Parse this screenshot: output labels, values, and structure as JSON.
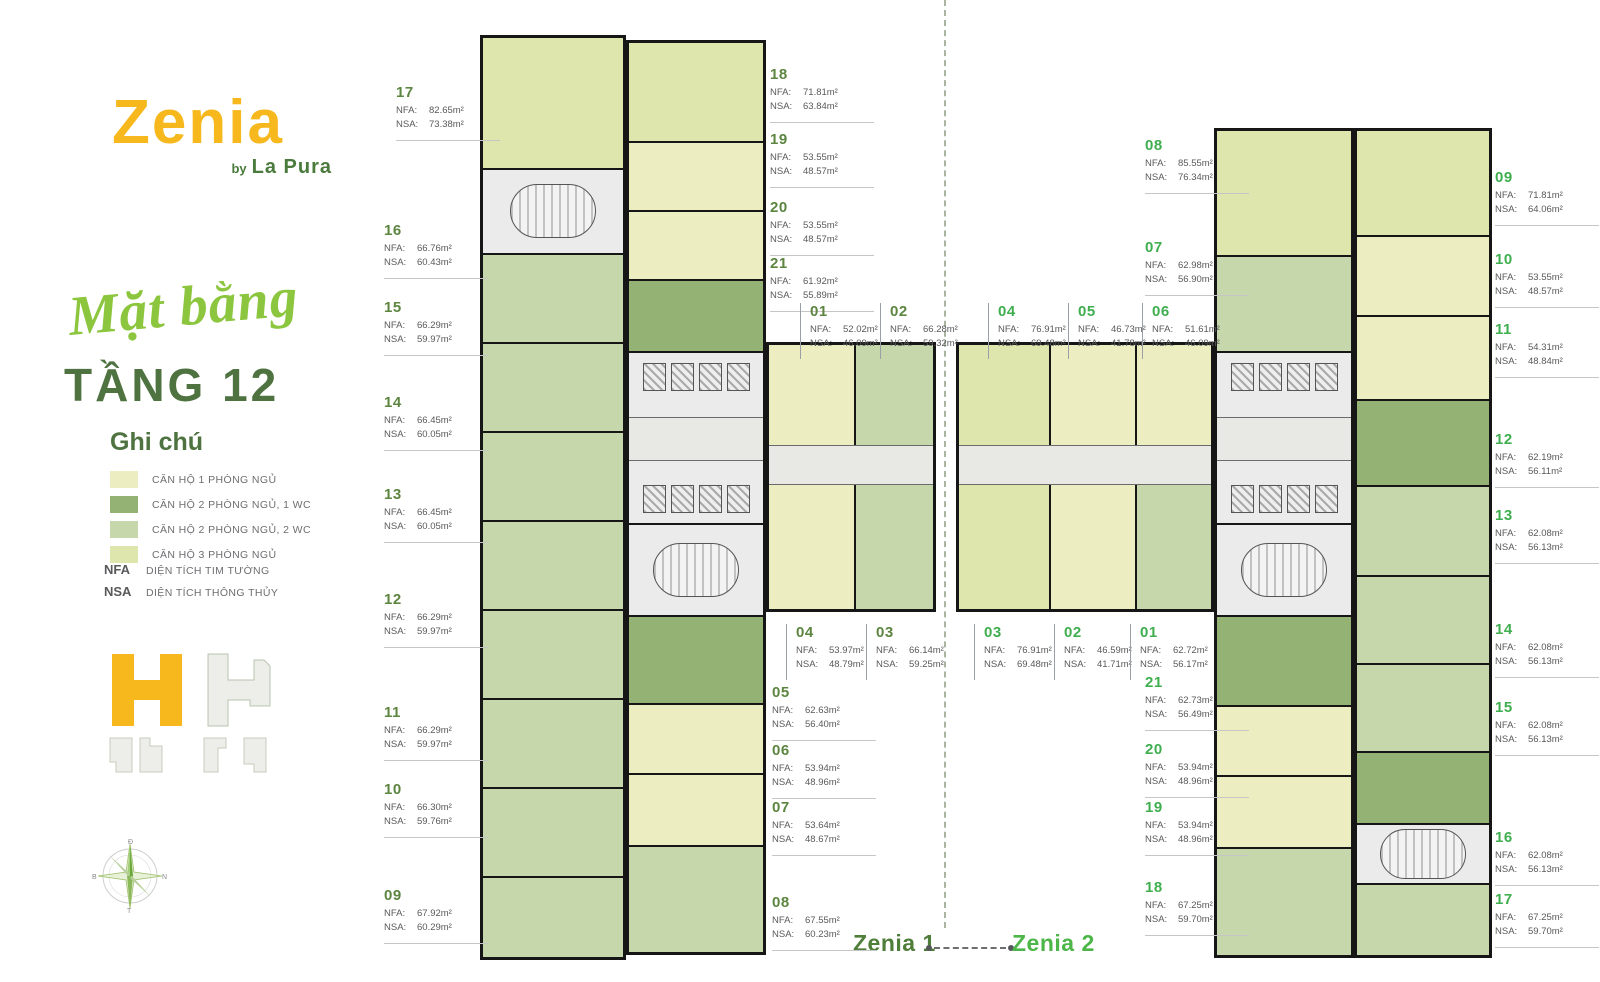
{
  "brand": {
    "name": "Zenia",
    "by": "by",
    "sub_brand": "La Pura"
  },
  "heading": {
    "script": "Mặt bằng",
    "floor": "TẦNG 12"
  },
  "legend": {
    "title": "Ghi chú",
    "types": [
      {
        "label": "CĂN HỘ 1 PHÒNG NGỦ",
        "color": "#ecedc0"
      },
      {
        "label": "CĂN HỘ 2 PHÒNG NGỦ, 1 WC",
        "color": "#94b274"
      },
      {
        "label": "CĂN HỘ 2 PHÒNG NGỦ, 2 WC",
        "color": "#c6d7ab"
      },
      {
        "label": "CĂN HỘ 3 PHÒNG NGỦ",
        "color": "#dee6ad"
      }
    ],
    "abbreviations": [
      {
        "key": "NFA",
        "label": "DIỆN TÍCH TIM TƯỜNG"
      },
      {
        "key": "NSA",
        "label": "DIỆN TÍCH THÔNG THỦY"
      }
    ]
  },
  "footer": {
    "left_tower": "Zenia 1",
    "right_tower": "Zenia 2"
  },
  "compass": {
    "top": "Đ",
    "right": "N",
    "bottom": "T",
    "left": "B"
  },
  "unit_labels": [
    {
      "tower": "z1",
      "no": "17",
      "nfa": "82.65m²",
      "nsa": "73.38m²",
      "x": 396,
      "y": 84
    },
    {
      "tower": "z1",
      "no": "16",
      "nfa": "66.76m²",
      "nsa": "60.43m²",
      "x": 384,
      "y": 222
    },
    {
      "tower": "z1",
      "no": "15",
      "nfa": "66.29m²",
      "nsa": "59.97m²",
      "x": 384,
      "y": 299
    },
    {
      "tower": "z1",
      "no": "14",
      "nfa": "66.45m²",
      "nsa": "60.05m²",
      "x": 384,
      "y": 394
    },
    {
      "tower": "z1",
      "no": "13",
      "nfa": "66.45m²",
      "nsa": "60.05m²",
      "x": 384,
      "y": 486
    },
    {
      "tower": "z1",
      "no": "12",
      "nfa": "66.29m²",
      "nsa": "59.97m²",
      "x": 384,
      "y": 591
    },
    {
      "tower": "z1",
      "no": "11",
      "nfa": "66.29m²",
      "nsa": "59.97m²",
      "x": 384,
      "y": 704
    },
    {
      "tower": "z1",
      "no": "10",
      "nfa": "66.30m²",
      "nsa": "59.76m²",
      "x": 384,
      "y": 781
    },
    {
      "tower": "z1",
      "no": "09",
      "nfa": "67.92m²",
      "nsa": "60.29m²",
      "x": 384,
      "y": 887
    },
    {
      "tower": "z1",
      "no": "18",
      "nfa": "71.81m²",
      "nsa": "63.84m²",
      "x": 770,
      "y": 66
    },
    {
      "tower": "z1",
      "no": "19",
      "nfa": "53.55m²",
      "nsa": "48.57m²",
      "x": 770,
      "y": 131
    },
    {
      "tower": "z1",
      "no": "20",
      "nfa": "53.55m²",
      "nsa": "48.57m²",
      "x": 770,
      "y": 199
    },
    {
      "tower": "z1",
      "no": "21",
      "nfa": "61.92m²",
      "nsa": "55.89m²",
      "x": 770,
      "y": 255
    },
    {
      "tower": "z1",
      "no": "01",
      "nfa": "52.02m²",
      "nsa": "46.09m²",
      "x": 800,
      "y": 303,
      "vl": true
    },
    {
      "tower": "z1",
      "no": "02",
      "nfa": "66.28m²",
      "nsa": "59.32m²",
      "x": 880,
      "y": 303,
      "vl": true
    },
    {
      "tower": "z1",
      "no": "04",
      "nfa": "53.97m²",
      "nsa": "48.79m²",
      "x": 786,
      "y": 624,
      "vl": true
    },
    {
      "tower": "z1",
      "no": "03",
      "nfa": "66.14m²",
      "nsa": "59.25m²",
      "x": 866,
      "y": 624,
      "vl": true
    },
    {
      "tower": "z1",
      "no": "05",
      "nfa": "62.63m²",
      "nsa": "56.40m²",
      "x": 772,
      "y": 684
    },
    {
      "tower": "z1",
      "no": "06",
      "nfa": "53.94m²",
      "nsa": "48.96m²",
      "x": 772,
      "y": 742
    },
    {
      "tower": "z1",
      "no": "07",
      "nfa": "53.64m²",
      "nsa": "48.67m²",
      "x": 772,
      "y": 799
    },
    {
      "tower": "z1",
      "no": "08",
      "nfa": "67.55m²",
      "nsa": "60.23m²",
      "x": 772,
      "y": 894
    },
    {
      "tower": "z2",
      "no": "04",
      "nfa": "76.91m²",
      "nsa": "69.48m²",
      "x": 988,
      "y": 303,
      "vl": true
    },
    {
      "tower": "z2",
      "no": "05",
      "nfa": "46.73m²",
      "nsa": "41.78m²",
      "x": 1068,
      "y": 303,
      "vl": true
    },
    {
      "tower": "z2",
      "no": "06",
      "nfa": "51.61m²",
      "nsa": "46.09m²",
      "x": 1142,
      "y": 303,
      "vl": true
    },
    {
      "tower": "z2",
      "no": "03",
      "nfa": "76.91m²",
      "nsa": "69.48m²",
      "x": 974,
      "y": 624,
      "vl": true
    },
    {
      "tower": "z2",
      "no": "02",
      "nfa": "46.59m²",
      "nsa": "41.71m²",
      "x": 1054,
      "y": 624,
      "vl": true
    },
    {
      "tower": "z2",
      "no": "01",
      "nfa": "62.72m²",
      "nsa": "56.17m²",
      "x": 1130,
      "y": 624,
      "vl": true
    },
    {
      "tower": "z2",
      "no": "08",
      "nfa": "85.55m²",
      "nsa": "76.34m²",
      "x": 1145,
      "y": 137
    },
    {
      "tower": "z2",
      "no": "07",
      "nfa": "62.98m²",
      "nsa": "56.90m²",
      "x": 1145,
      "y": 239
    },
    {
      "tower": "z2",
      "no": "21",
      "nfa": "62.73m²",
      "nsa": "56.49m²",
      "x": 1145,
      "y": 674
    },
    {
      "tower": "z2",
      "no": "20",
      "nfa": "53.94m²",
      "nsa": "48.96m²",
      "x": 1145,
      "y": 741
    },
    {
      "tower": "z2",
      "no": "19",
      "nfa": "53.94m²",
      "nsa": "48.96m²",
      "x": 1145,
      "y": 799
    },
    {
      "tower": "z2",
      "no": "18",
      "nfa": "67.25m²",
      "nsa": "59.70m²",
      "x": 1145,
      "y": 879
    },
    {
      "tower": "z2",
      "no": "09",
      "nfa": "71.81m²",
      "nsa": "64.06m²",
      "x": 1495,
      "y": 169
    },
    {
      "tower": "z2",
      "no": "10",
      "nfa": "53.55m²",
      "nsa": "48.57m²",
      "x": 1495,
      "y": 251
    },
    {
      "tower": "z2",
      "no": "11",
      "nfa": "54.31m²",
      "nsa": "48.84m²",
      "x": 1495,
      "y": 321
    },
    {
      "tower": "z2",
      "no": "12",
      "nfa": "62.19m²",
      "nsa": "56.11m²",
      "x": 1495,
      "y": 431
    },
    {
      "tower": "z2",
      "no": "13",
      "nfa": "62.08m²",
      "nsa": "56.13m²",
      "x": 1495,
      "y": 507
    },
    {
      "tower": "z2",
      "no": "14",
      "nfa": "62.08m²",
      "nsa": "56.13m²",
      "x": 1495,
      "y": 621
    },
    {
      "tower": "z2",
      "no": "15",
      "nfa": "62.08m²",
      "nsa": "56.13m²",
      "x": 1495,
      "y": 699
    },
    {
      "tower": "z2",
      "no": "16",
      "nfa": "62.08m²",
      "nsa": "56.13m²",
      "x": 1495,
      "y": 829
    },
    {
      "tower": "z2",
      "no": "17",
      "nfa": "67.25m²",
      "nsa": "59.70m²",
      "x": 1495,
      "y": 891
    }
  ]
}
